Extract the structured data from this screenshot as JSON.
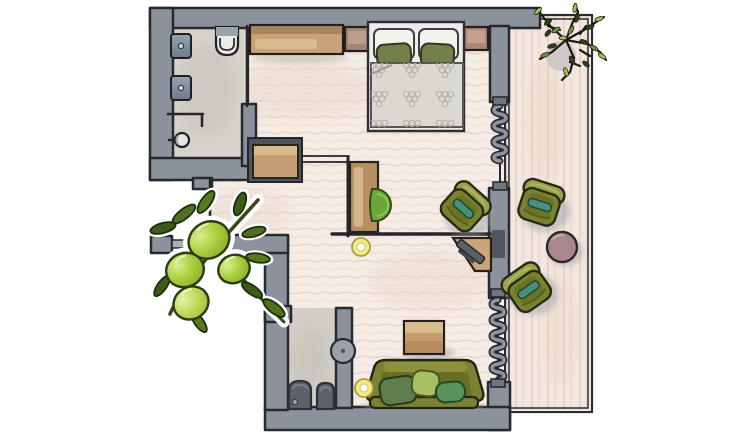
{
  "scene": {
    "type": "floor-plan-illustration",
    "description": "Hand-drawn watercolor floor plan of a hotel suite seen from above",
    "canvas": {
      "width": 754,
      "height": 435
    }
  },
  "palette": {
    "wall_gray": "#8b929c",
    "wall_outline": "#26292e",
    "floor_wood": "#f5ece6",
    "floor_grain": "#e4d0c6",
    "tile_gray": "#d6d2ca",
    "furniture_wood": "#c49d72",
    "sofa_olive": "#7b8034",
    "chair_olive": "#79832f",
    "bright_olive_green": "#accf3f",
    "teal_accent": "#4a917c",
    "lamp_yellow": "#f6e97e",
    "side_table_mauve": "#a8878d"
  },
  "rooms": {
    "bathroom": {
      "label": "Bathroom",
      "fixtures": [
        "washbasin",
        "washbasin",
        "wall-hung toilet",
        "shower"
      ]
    },
    "bedroom": {
      "label": "Bedroom area",
      "furniture": [
        "sideboard wardrobe",
        "nightstand",
        "double bed with green pillows",
        "nightstand",
        "dresser",
        "desk",
        "desk chair",
        "lounge chair",
        "corner TV shelf",
        "floor lamp"
      ]
    },
    "living": {
      "label": "Living area",
      "furniture": [
        "coffee table",
        "sofa with three green cushions",
        "floor lamp"
      ]
    },
    "wc": {
      "label": "Guest WC",
      "fixtures": [
        "toilet",
        "bidet",
        "round washbasin"
      ]
    },
    "balcony": {
      "label": "Balcony with wooden deck",
      "furniture": [
        "armchair",
        "round side table",
        "armchair",
        "potted plant"
      ]
    }
  },
  "doors": {
    "folding_door_upper": "Folding door to balcony (upper)",
    "folding_door_lower": "Folding door to balcony (lower)"
  },
  "decor": {
    "olive_branch": {
      "label": "Olive branch illustration"
    },
    "balcony_plant": {
      "label": "Potted plant seen from above"
    }
  }
}
